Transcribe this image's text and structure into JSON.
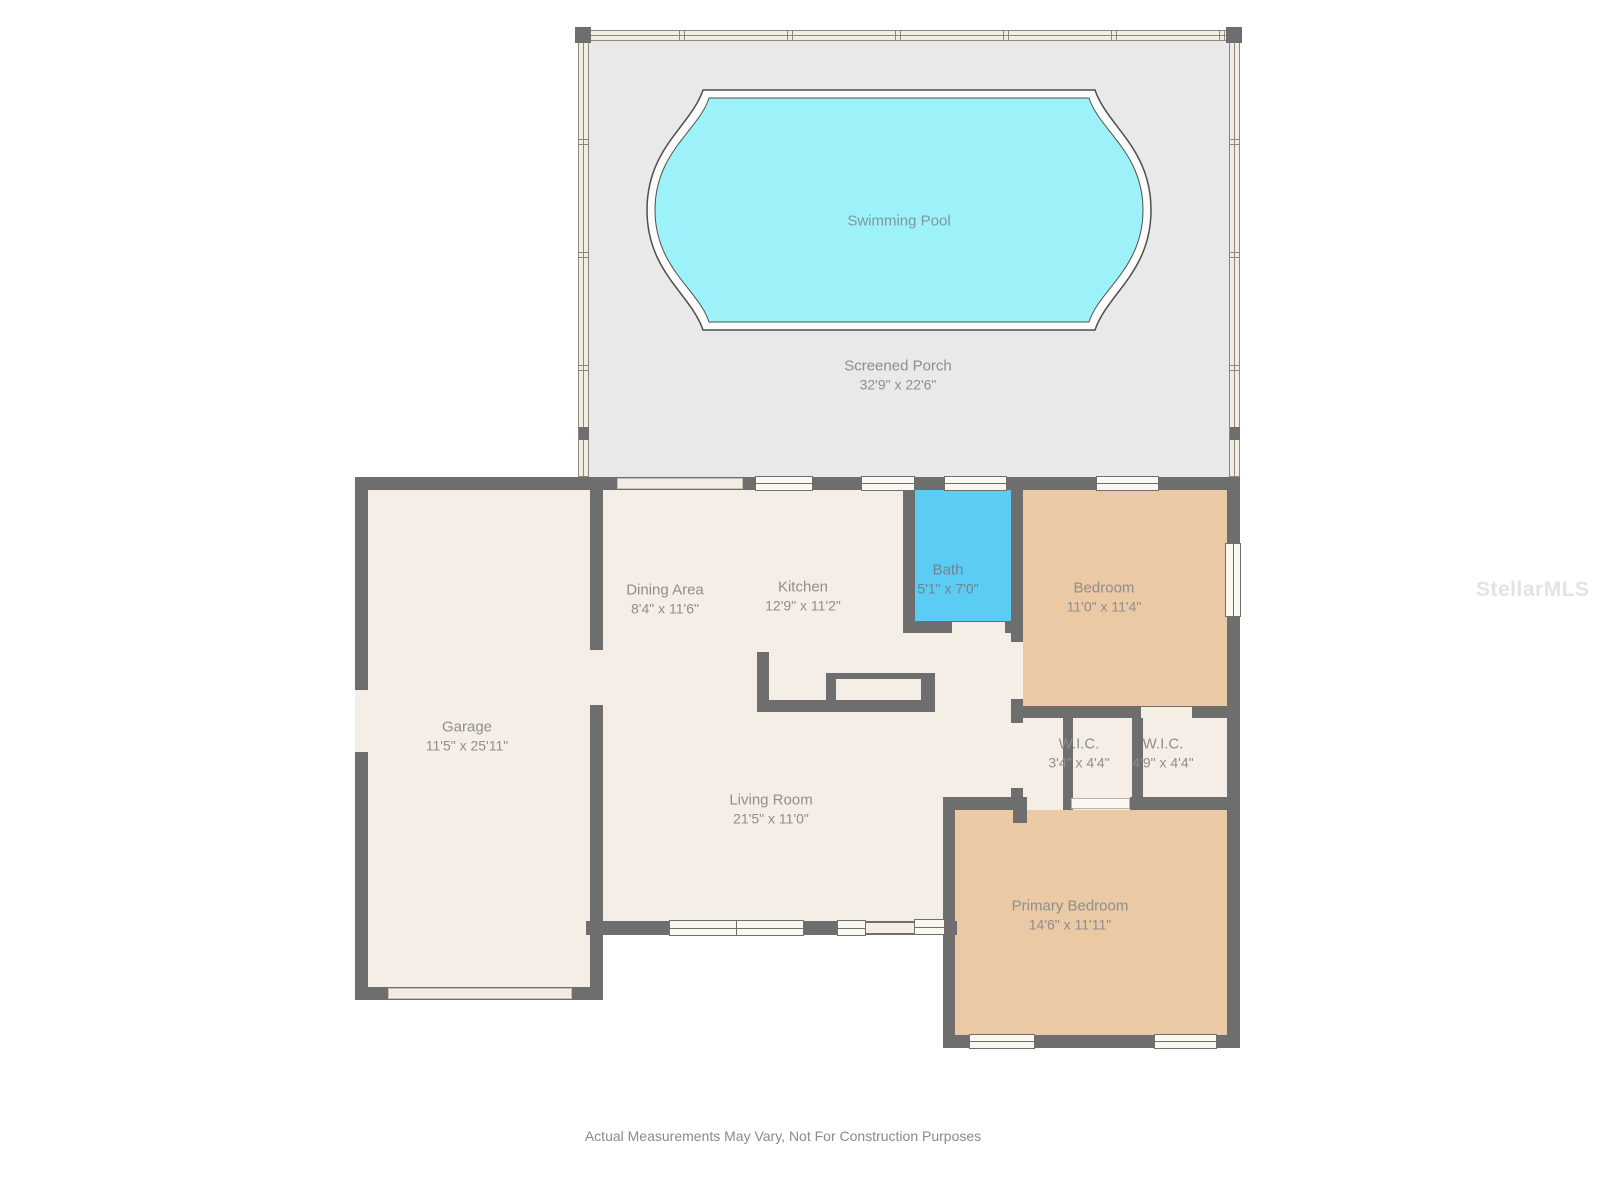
{
  "rooms": [
    {
      "label": "Swimming Pool",
      "dims": ""
    },
    {
      "label": "Screened Porch",
      "dims": "32'9\" x 22'6\""
    },
    {
      "label": "Dining Area",
      "dims": "8'4\" x 11'6\""
    },
    {
      "label": "Kitchen",
      "dims": "12'9\" x 11'2\""
    },
    {
      "label": "Bath",
      "dims": "5'1\" x 7'0\""
    },
    {
      "label": "Bedroom",
      "dims": "11'0\" x 11'4\""
    },
    {
      "label": "Garage",
      "dims": "11'5\" x 25'11\""
    },
    {
      "label": "W.I.C.",
      "dims": "3'4\" x 4'4\""
    },
    {
      "label": "W.I.C.",
      "dims": "4'9\" x 4'4\""
    },
    {
      "label": "Living Room",
      "dims": "21'5\" x 11'0\""
    },
    {
      "label": "Primary Bedroom",
      "dims": "14'6\" x 11'11\""
    }
  ],
  "footer": {
    "disclaimer": "Actual Measurements May Vary, Not For Construction Purposes"
  },
  "watermark": "StellarMLS",
  "colors": {
    "pool_water": "#9df2fa",
    "bath_floor": "#5bcdf4",
    "bedroom_floor": "#eac9a4",
    "house_floor": "#f5eee7",
    "porch_floor": "#e9e9e9",
    "wall": "#6e6e6e",
    "label_text": "#8e8e8e"
  }
}
